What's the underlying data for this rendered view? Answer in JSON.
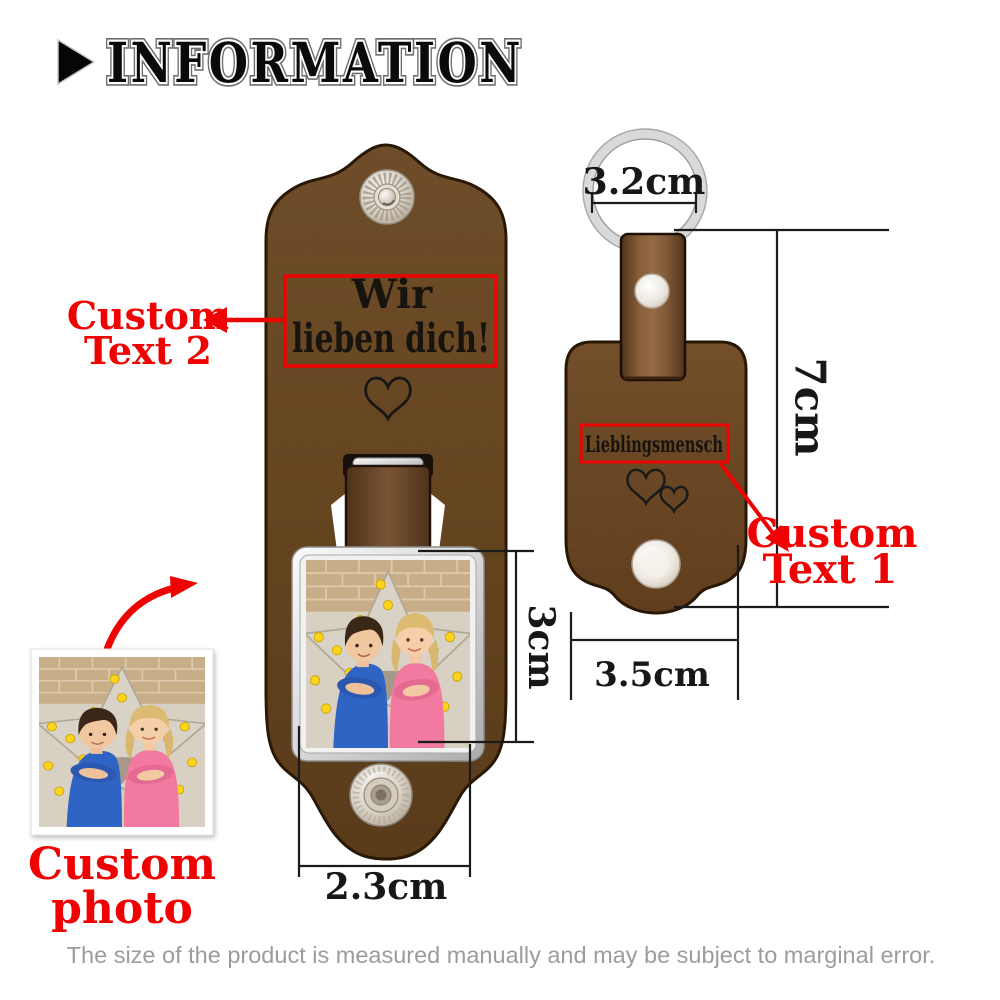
{
  "header": {
    "title": "INFORMATION",
    "bullet_icon": "play-triangle-icon"
  },
  "left_keychain": {
    "description": "open leather keychain with custom engraving and photo frame",
    "engraving": {
      "line1": "Wir",
      "line2": "lieben dich!"
    },
    "heart_icon": "heart-outline-icon",
    "snap_icon": "snap-button"
  },
  "right_keychain": {
    "description": "closed leather keychain with key ring and engraving",
    "engraving": "Lieblingsmensch",
    "hearts_icon": "double-hearts-outline-icon",
    "ring_icon": "key-ring"
  },
  "annotations": {
    "custom_text_1": {
      "line1": "Custom",
      "line2": "Text 1"
    },
    "custom_text_2": {
      "line1": "Custom",
      "line2": "Text 2"
    },
    "custom_photo": {
      "line1": "Custom",
      "line2": "photo"
    }
  },
  "measurements": {
    "ring_diameter": "3.2cm",
    "total_height": "7cm",
    "body_width": "3.5cm",
    "photo_height": "3cm",
    "photo_width": "2.3cm"
  },
  "footer": {
    "disclaimer": "The size of the product is measured manually and may be subject to marginal error."
  },
  "colors": {
    "accent_red": "#ee0202",
    "leather_brown": "#7c5638",
    "leather_edge": "#241403",
    "metal_silver": "#d9d9d9",
    "engraving_black": "#17130f",
    "disclaimer_gray": "#9c9c9c"
  },
  "icons": [
    "play-triangle-icon",
    "key-ring",
    "snap-button",
    "rivet",
    "heart-outline-icon",
    "double-hearts-outline-icon",
    "arrow-left-icon",
    "arrow-diagonal-icon",
    "arrow-curved-icon"
  ]
}
